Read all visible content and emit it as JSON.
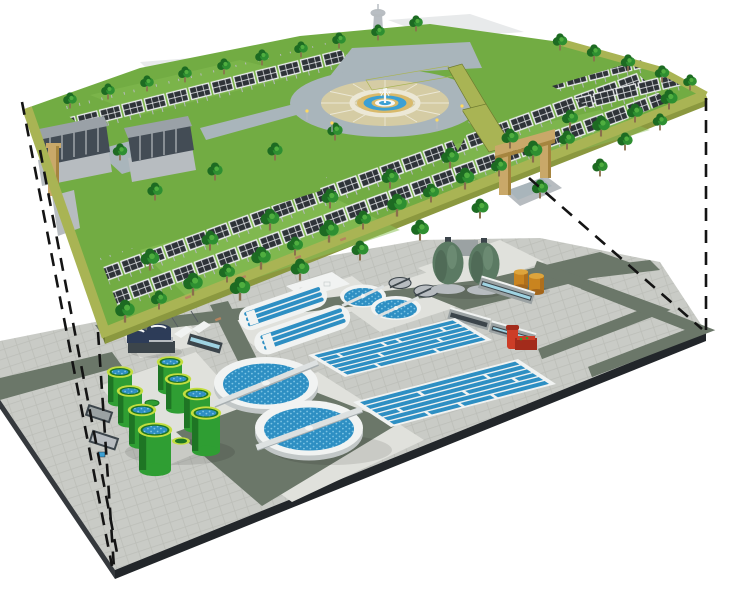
{
  "meta": {
    "title": "Concept render: rooftop solar park built above a wastewater treatment plant",
    "description": "Two-level 3D concept illustration. Upper level: green deck with tree-lined solar panel arrays, two office buildings, a lookout tower and a circular fountain plaza with entrance gates. Lower level: wastewater treatment plant with secondary clarifiers, oxidation ditches, aeration basins, green digester tanks, egg-shaped digesters, storage tanks and service buildings. Dashed projection lines link the corners of the two levels.",
    "canvas": {
      "width": 740,
      "height": 589
    }
  },
  "colors": {
    "bg": "#ffffff",
    "grass": "#72ac43",
    "grassLight": "#8cc25a",
    "edgeTop": "#a9b454",
    "edgeSide": "#8b983f",
    "edgeSideDark": "#6e7b30",
    "treeDark": "#1d6b22",
    "treeMid": "#2e8f31",
    "treeLight": "#4fae3f",
    "trunk": "#8a6f4d",
    "panel": "#2e3338",
    "panelFrame": "#eef0f2",
    "post": "#b6babe",
    "bldRoof": "#9aa1a7",
    "bldGlass": "#434c55",
    "bldBase": "#b7bcc0",
    "ringRoad": "#a9b5bb",
    "pavers": "#d5cca4",
    "paverRing": "#ece8d6",
    "fountTan": "#d9ba6b",
    "fountBlue": "#3ba0d4",
    "white": "#f6f8f8",
    "tower": "#b9bec3",
    "silhouette": "#e8eaeb",
    "gateTan": "#c9a869",
    "gateShade": "#a6853f",
    "paving": "#c9cbc6",
    "pavingLine": "#bcbeb8",
    "pad": "#e0e1dc",
    "road": "#6b7769",
    "edgeDark": "#22262a",
    "edgeMid": "#35393d",
    "wall": "#f1f3f2",
    "wallShade": "#c2c7c7",
    "water": "#2e8fc3",
    "waterDot": "#7cc4e4",
    "bridge": "#dde1e1",
    "bridgeShade": "#a8afb1",
    "digGreen": "#2f9e33",
    "digDark": "#1e7524",
    "digRim": "#c3de3f",
    "egg": "#5b7a63",
    "eggDark": "#42594a",
    "eggLight": "#78987f",
    "navy": "#2d3c58",
    "orange": "#c9841f",
    "orangeDark": "#a3661b",
    "orangeTop": "#dda43c",
    "red": "#cd3d27",
    "redDark": "#a32b1b",
    "grayBld": "#9ba2a3",
    "grayBldDark": "#3c454b",
    "screen": "#9fd3e2",
    "bench": "#b5845f",
    "lamp": "#ffd95e",
    "dash": "#141414"
  },
  "scene": {
    "upper_deck": {
      "label": "solar park deck",
      "components": [
        "solar-panel-arrays",
        "trees",
        "office-buildings",
        "lookout-tower",
        "fountain-plaza",
        "entrance-gate",
        "hedges",
        "benches",
        "lamp-posts"
      ]
    },
    "lower_deck": {
      "label": "wastewater treatment plant",
      "components": [
        "secondary-clarifiers",
        "primary-clarifiers",
        "mini-clarifiers",
        "oxidation-ditches",
        "aeration-basins",
        "digester-tanks-green",
        "egg-digesters",
        "gravity-thickeners",
        "inlet-screens",
        "storage-tanks-orange",
        "pump-unit-red",
        "service-buildings",
        "shelters",
        "roads"
      ]
    },
    "counts": {
      "digester_tanks_green": 8,
      "egg_digesters": 2,
      "secondary_clarifiers": 2,
      "primary_clarifiers": 2,
      "mini_clarifiers": 2,
      "oxidation_ditches": 2,
      "aeration_basin_blocks": 2,
      "orange_tanks": 2,
      "office_buildings": 2,
      "projection_lines": 5
    },
    "projection_lines": {
      "style": "dashed"
    }
  }
}
